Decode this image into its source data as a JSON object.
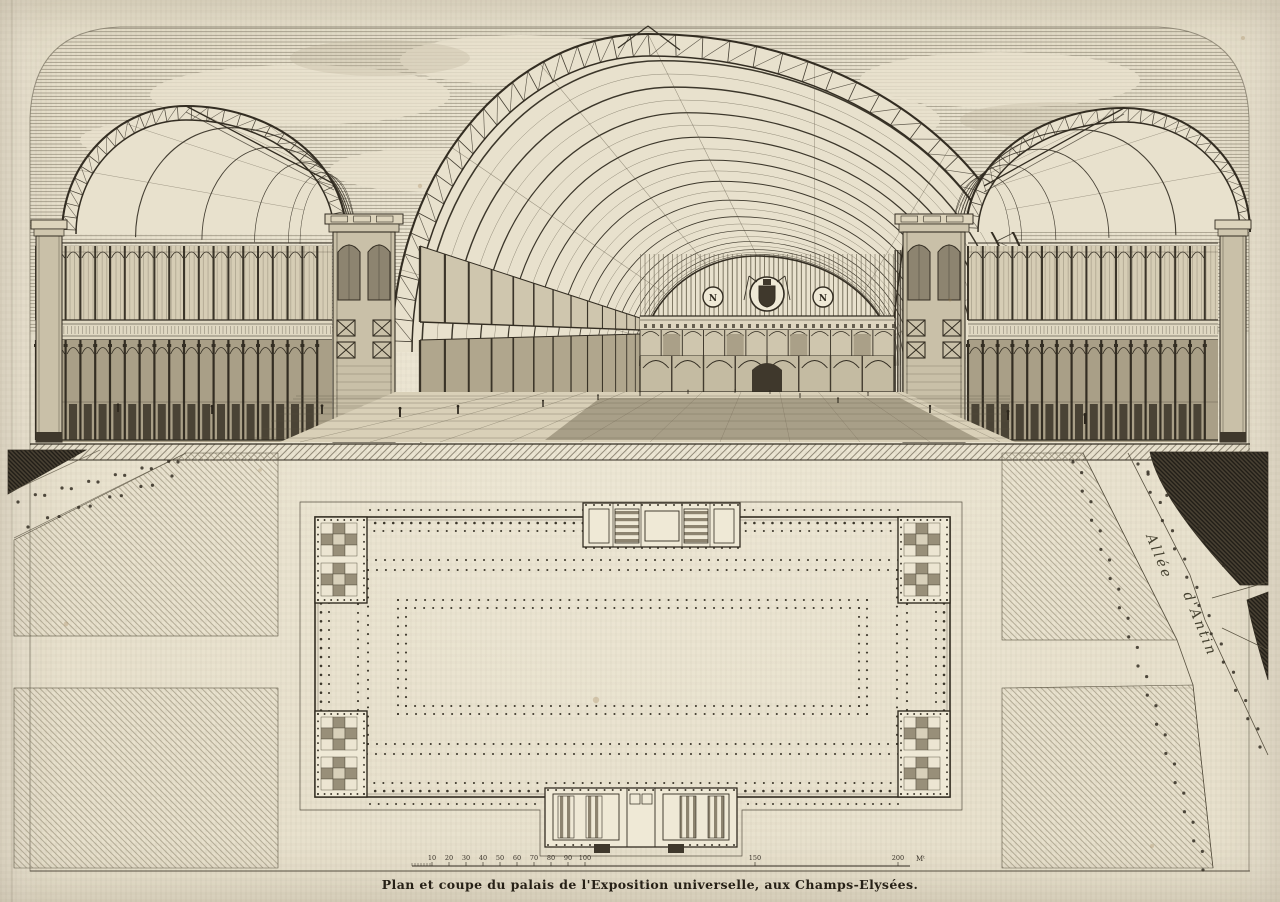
{
  "plate": {
    "caption": "Plan et coupe du palais de l'Exposition universelle, aux Champs-Elysées.",
    "street_label": {
      "line1": "Allée",
      "line2": "d'Antin"
    },
    "medallion_monogram": "N",
    "scale_bar": {
      "tick_labels": [
        "10",
        "20",
        "30",
        "40",
        "50",
        "60",
        "70",
        "80",
        "90",
        "100",
        "150",
        "200"
      ],
      "unit": "Mᵗ"
    },
    "colors": {
      "paper": "#e8e1cd",
      "paper_light": "#efe9d6",
      "ink": "#332d22",
      "ink_mid": "#57503f",
      "ink_light": "#8d8470",
      "dark_fill": "#3f382c",
      "lawn_hatch": "#948b74",
      "stain": "#9b7b4c"
    }
  }
}
